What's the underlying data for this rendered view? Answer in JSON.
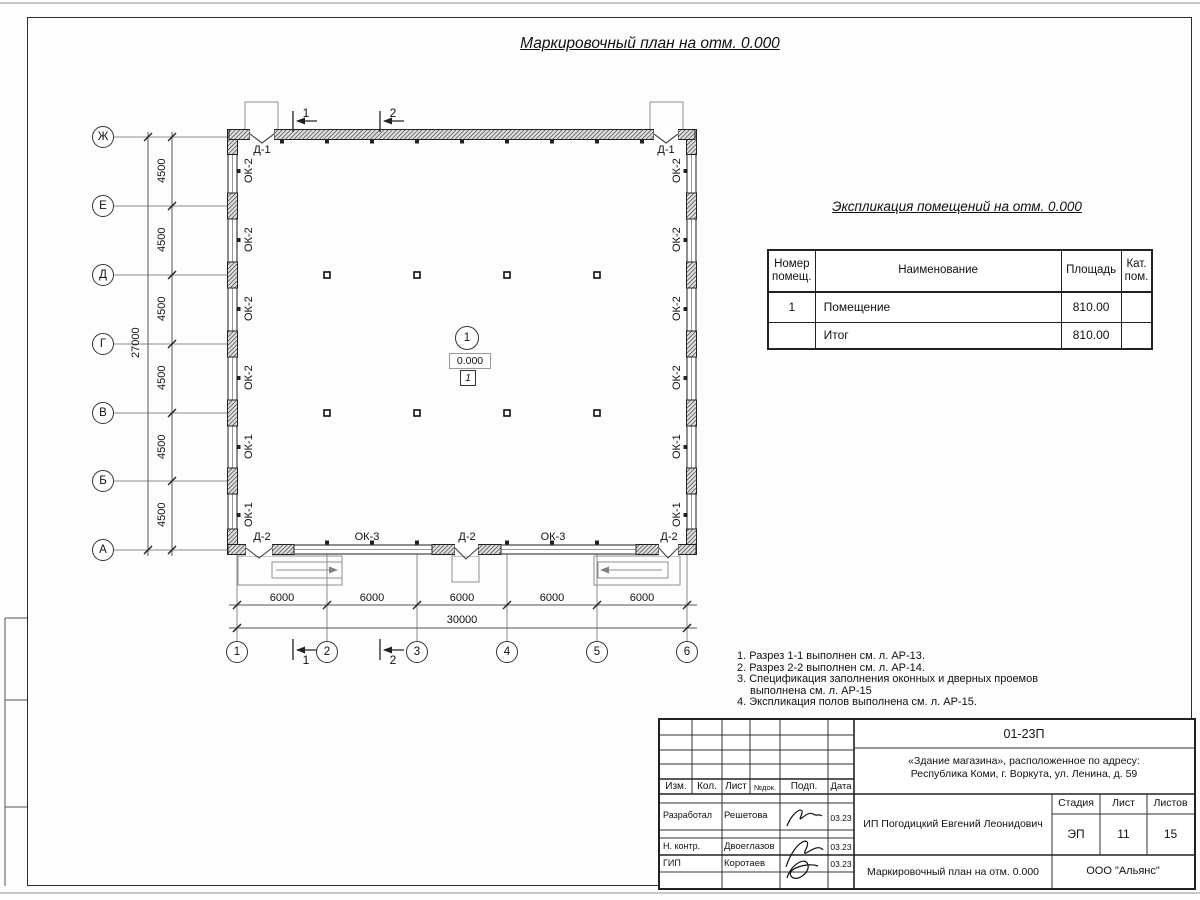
{
  "sheet": {
    "main_title": "Маркировочный план на отм. 0.000"
  },
  "plan": {
    "row_axes": [
      "Ж",
      "Е",
      "Д",
      "Г",
      "В",
      "Б",
      "А"
    ],
    "col_axes": [
      "1",
      "2",
      "3",
      "4",
      "5",
      "6"
    ],
    "v_dims": [
      "4500",
      "4500",
      "4500",
      "4500",
      "4500",
      "4500"
    ],
    "v_total": "27000",
    "h_dims": [
      "6000",
      "6000",
      "6000",
      "6000",
      "6000"
    ],
    "h_total": "30000",
    "left_windows": [
      "ОК-2",
      "ОК-2",
      "ОК-2",
      "ОК-2",
      "ОК-1",
      "ОК-1"
    ],
    "right_windows": [
      "ОК-2",
      "ОК-2",
      "ОК-2",
      "ОК-2",
      "ОК-1",
      "ОК-1"
    ],
    "top_doors": [
      "Д-1",
      "Д-1"
    ],
    "bottom_openings": [
      "Д-2",
      "ОК-3",
      "Д-2",
      "ОК-3",
      "Д-2"
    ],
    "sections": {
      "s1": "1",
      "s2": "2"
    },
    "room": {
      "number": "1",
      "level": "0.000",
      "floor_type": "1"
    }
  },
  "explication": {
    "title": "Экспликация помещений на отм. 0.000",
    "headers": {
      "num": "Номер помещ.",
      "name": "Наименование",
      "area": "Площадь",
      "cat": "Кат. пом."
    },
    "rows": [
      {
        "num": "1",
        "name": "Помещение",
        "area": "810.00",
        "cat": ""
      },
      {
        "num": "",
        "name": "Итог",
        "area": "810.00",
        "cat": ""
      }
    ]
  },
  "notes": {
    "items": [
      "1. Разрез 1-1 выполнен см. л. АР-13.",
      "2. Разрез 2-2 выполнен см. л. АР-14.",
      "3. Спецификация заполнения оконных и дверных проемов выполнена см. л. АР-15",
      "4. Экспликация полов выполнена см. л. АР-15."
    ]
  },
  "stamp": {
    "doc_code": "01-23П",
    "object_line1": "«Здание магазина», расположенное по адресу:",
    "object_line2": "Республика Коми, г. Воркута, ул. Ленина, д. 59",
    "cols": {
      "izm": "Изм.",
      "kol": "Кол.",
      "list": "Лист",
      "ndok": "№док.",
      "podp": "Подп.",
      "data": "Дата"
    },
    "rows": [
      {
        "role": "Разработал",
        "name": "Решетова",
        "date": "03.23"
      },
      {
        "role": "Н. контр.",
        "name": "Двоеглазов",
        "date": "03.23"
      },
      {
        "role": "ГИП",
        "name": "Коротаев",
        "date": "03.23"
      }
    ],
    "client": "ИП Погодицкий Евгений Леонидович",
    "stage_label": "Стадия",
    "list_label": "Лист",
    "listov_label": "Листов",
    "stage": "ЭП",
    "list": "11",
    "listov": "15",
    "doc_title": "Маркировочный план на отм. 0.000",
    "org": "ООО \"Альянс\""
  }
}
